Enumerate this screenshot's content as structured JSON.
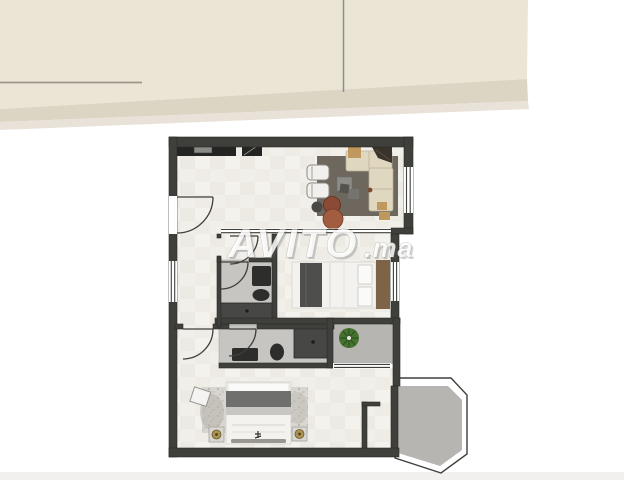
{
  "watermark": {
    "brand": "AVITO",
    "tld": ".ma"
  },
  "colors": {
    "banner": "#ebe5d6",
    "banner-shade": "#dcd5c4",
    "banner-soft": "#e9e2d9",
    "wall": "#3f3f3b",
    "wall-edge": "#2a2a27",
    "tile": "#f1efe9",
    "tile-alt": "#e8e5dd",
    "bath-floor": "#c7c5c2",
    "terrace-floor": "#b6b5b2",
    "rug": "#6e675d",
    "sofa": "#e0d7c1",
    "wood": "#7d6348",
    "fixture-dark": "#2d2d2b",
    "shower": "#474745",
    "bed-white": "#f3f2ef",
    "throw-dark": "#4e4e4c",
    "blanket-gray": "#6f6f6d",
    "rug2": "#d9d6d0",
    "gold": "#ab9152",
    "plant": "#46722f",
    "pouf-dark": "#8a4a33",
    "pouf-light": "#a25c40",
    "tan": "#c0975d",
    "line-gray": "#8e8e88",
    "line-warm": "#9c968c",
    "watermark-fill": "rgba(255,255,255,0.85)"
  }
}
